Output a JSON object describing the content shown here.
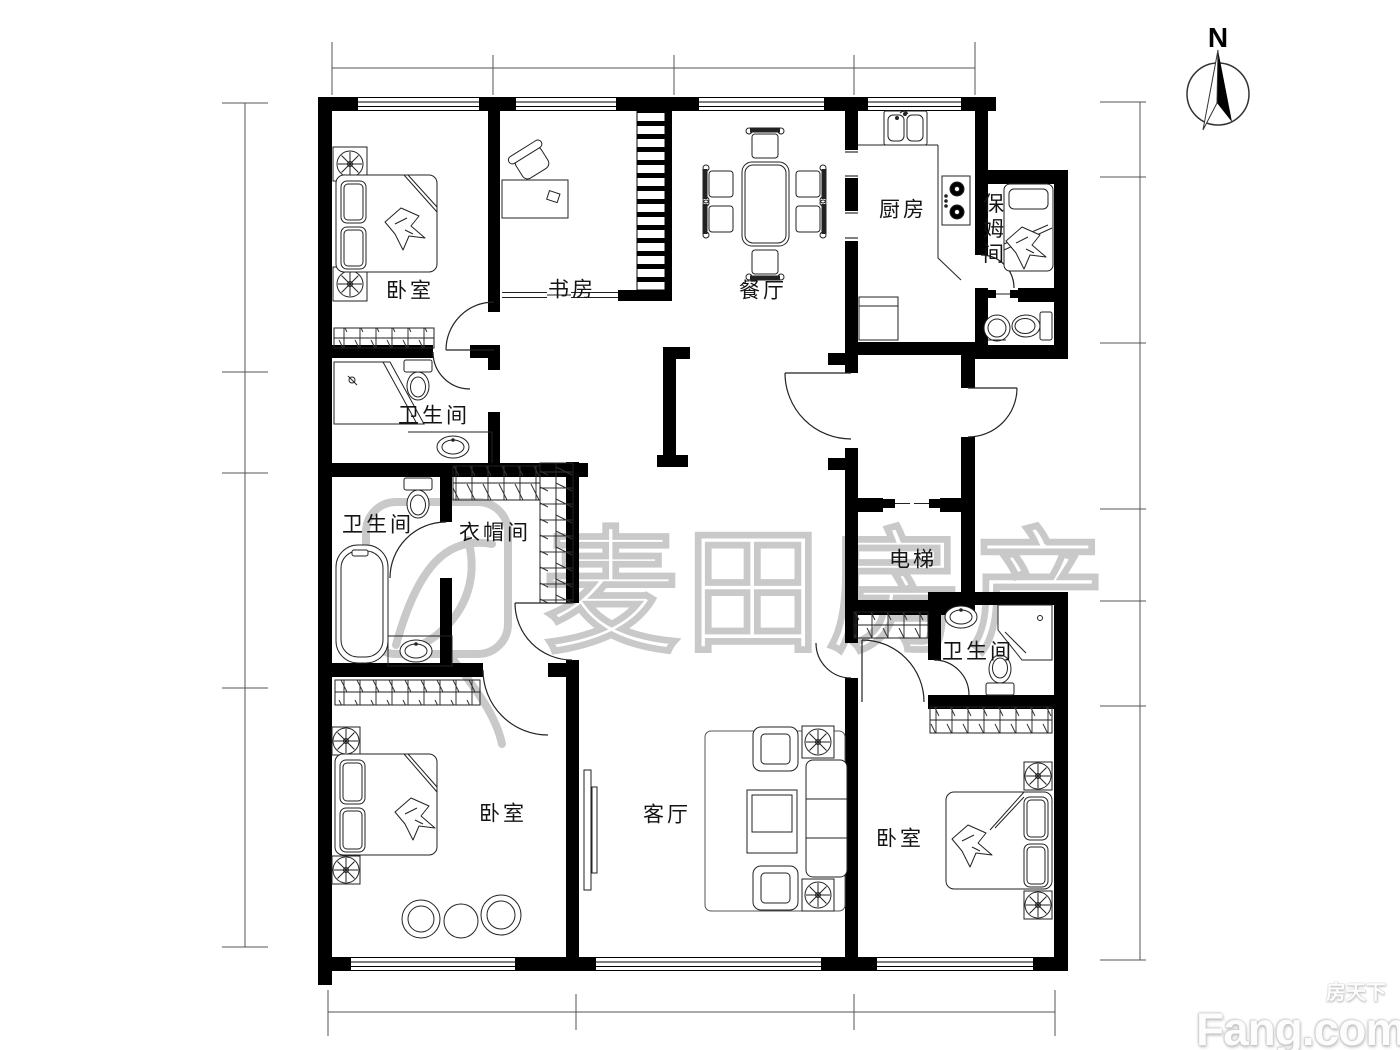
{
  "page": {
    "background": "#ffffff",
    "wall_color": "#000000",
    "line_color": "#222222",
    "watermark_color": "#c9c9c9"
  },
  "compass": {
    "label": "N"
  },
  "watermark": {
    "text": "麦田房产"
  },
  "footer": {
    "logo_main": "Fang.com",
    "logo_sub": "房天下"
  },
  "plan": {
    "rooms": [
      {
        "id": "bedroom-top-left",
        "label": "卧室",
        "x": 410,
        "y": 291
      },
      {
        "id": "study",
        "label": "书房",
        "x": 572,
        "y": 290
      },
      {
        "id": "dining-room",
        "label": "餐厅",
        "x": 763,
        "y": 291
      },
      {
        "id": "kitchen",
        "label": "厨房",
        "x": 903,
        "y": 210
      },
      {
        "id": "nanny-room",
        "label": "保姆间",
        "x": 992,
        "y": 230,
        "vertical": true
      },
      {
        "id": "bathroom-top",
        "label": "卫生间",
        "x": 434,
        "y": 416
      },
      {
        "id": "bathroom-left",
        "label": "卫生间",
        "x": 378,
        "y": 525
      },
      {
        "id": "cloakroom",
        "label": "衣帽间",
        "x": 495,
        "y": 533
      },
      {
        "id": "elevator",
        "label": "电梯",
        "x": 913,
        "y": 560
      },
      {
        "id": "bathroom-right",
        "label": "卫生间",
        "x": 978,
        "y": 652
      },
      {
        "id": "bedroom-bottom-left",
        "label": "卧室",
        "x": 503,
        "y": 814
      },
      {
        "id": "living-room",
        "label": "客厅",
        "x": 667,
        "y": 815
      },
      {
        "id": "bedroom-bottom-right",
        "label": "卧室",
        "x": 900,
        "y": 839
      }
    ],
    "furniture_icons": [
      "double-bed-icon",
      "single-bed-icon",
      "pillow-icon",
      "quilt-icon",
      "nightstand-fan-icon",
      "wardrobe-hatch-icon",
      "bookshelf-icon",
      "desk-icon",
      "office-chair-icon",
      "dining-table-icon",
      "dining-chair-icon",
      "kitchen-sink-icon",
      "gas-stove-icon",
      "fridge-icon",
      "bathtub-icon",
      "toilet-icon",
      "washbasin-icon",
      "corner-shower-icon",
      "stool-icon",
      "sofa-icon",
      "armchair-icon",
      "coffee-table-icon",
      "side-table-icon",
      "tv-icon",
      "rug-icon",
      "lounge-chair-icon",
      "round-table-icon",
      "elevator-door-icon",
      "sliding-door-icon",
      "door-swing-icon",
      "window-icon",
      "north-arrow-icon",
      "dimension-line-icon"
    ]
  }
}
